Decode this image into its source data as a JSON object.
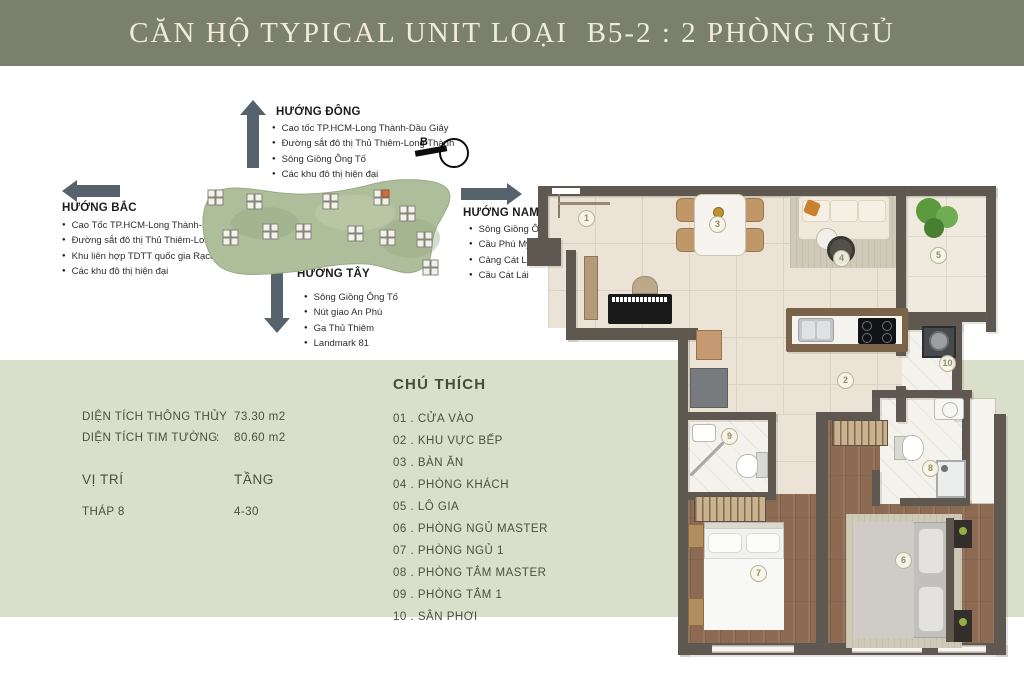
{
  "title": "CĂN HỘ TYPICAL UNIT LOẠI  B5-2 : 2 PHÒNG NGỦ",
  "compass": {
    "north_label": "B"
  },
  "directions": {
    "east": {
      "label": "HƯỚNG ĐÔNG",
      "items": [
        "Cao tốc TP.HCM-Long Thành-Dầu Giây",
        "Đường sắt đô thị Thủ Thiêm-Long Thành",
        "Sông Giồng Ông Tố",
        "Các khu đô thị hiện đại"
      ]
    },
    "north": {
      "label": "HƯỚNG BẮC",
      "items": [
        "Cao Tốc TP.HCM-Long Thành-Dầu Giây",
        "Đường sắt đô thị Thủ Thiêm-Long Thành",
        "Khu liên hợp TDTT quốc gia Rạch Chiếc",
        "Các khu đô thị hiện đại"
      ]
    },
    "south": {
      "label": "HƯỚNG NAM",
      "items": [
        "Sông Giồng Ông Tố",
        "Cầu Phú Mỹ",
        "Cảng Cát Lái",
        "Cầu Cát Lái"
      ]
    },
    "west": {
      "label": "HƯỚNG TÂY",
      "items": [
        "Sông Giồng Ông Tố",
        "Nút giao An Phú",
        "Ga Thủ Thiêm",
        "Landmark 81"
      ]
    }
  },
  "info": {
    "area_rows": [
      {
        "label": "DIỆN TÍCH THÔNG THỦY",
        "sep": ":",
        "value": "73.30 m2"
      },
      {
        "label": "DIỆN TÍCH TIM TƯỜNG",
        "sep": ":",
        "value": "80.60 m2"
      }
    ],
    "position_header": "VỊ TRÍ",
    "floor_header": "TẦNG",
    "position_value": "THÁP 8",
    "floor_value": "4-30"
  },
  "legend": {
    "title": "CHÚ THÍCH",
    "items": [
      "01 . CỬA VÀO",
      "02 . KHU VỰC BẾP",
      "03 . BÀN ĂN",
      "04 . PHÒNG KHÁCH",
      "05 . LÔ GIA",
      "06 . PHÒNG NGỦ MASTER",
      "07 . PHÒNG NGỦ 1",
      "08 . PHÒNG TẮM MASTER",
      "09 . PHÒNG TẮM 1",
      "10 . SÂN PHƠI"
    ]
  },
  "floorplan": {
    "markers": [
      "1",
      "2",
      "3",
      "4",
      "5",
      "6",
      "7",
      "8",
      "9",
      "10"
    ]
  },
  "colors": {
    "banner": "#7b7f6e",
    "banner_text": "#f0ecd8",
    "panel_green": "#d9dfca",
    "arrow": "#57636c",
    "wall": "#5e5850",
    "site_green": "#aebd9a",
    "highlight_tower": "#c96f3f"
  }
}
